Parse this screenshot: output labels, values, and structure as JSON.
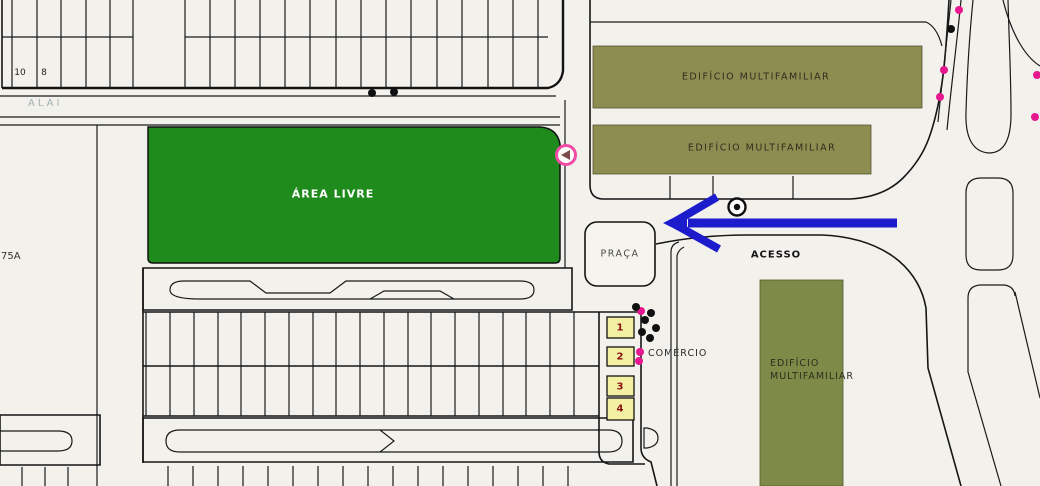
{
  "map": {
    "street_top": "ALAI",
    "street_left": "75A",
    "lot_number_1": "10",
    "lot_number_2": "8",
    "open_area": "ÁREA LIVRE",
    "building_top": "EDIFÍCIO MULTIFAMILIAR",
    "building_middle": "EDIFÍCIO MULTIFAMILIAR",
    "building_right_line1": "EDIFÍCIO",
    "building_right_line2": "MULTIFAMILIAR",
    "plaza": "PRAÇA",
    "access": "ACESSO",
    "commerce": "COMÉRCIO",
    "commerce_units": [
      "1",
      "2",
      "3",
      "4"
    ]
  },
  "colors": {
    "open_area_green": "#1f8b1d",
    "building_olive": "#8d8d52",
    "building_olive_dark": "#7e8b48",
    "commerce_yellow": "#f3f0a3",
    "arrow_blue": "#1c1ccd",
    "marker_magenta": "#e61890",
    "marker_ring_pink": "#f04ca6",
    "dot_black": "#101010"
  },
  "icons": {
    "access_direction": "arrow-left-icon",
    "stop_point": "circle-dot-icon",
    "corner_marker": "pink-circle-marker-icon"
  },
  "markers": {
    "magenta": [
      [
        959,
        10
      ],
      [
        944,
        70
      ],
      [
        940,
        97
      ],
      [
        1037,
        75
      ],
      [
        1035,
        117
      ],
      [
        641,
        311
      ],
      [
        640,
        352
      ],
      [
        639,
        361
      ]
    ],
    "black": [
      [
        951,
        29
      ],
      [
        372,
        93
      ],
      [
        394,
        92
      ],
      [
        636,
        307
      ],
      [
        651,
        313
      ],
      [
        645,
        320
      ],
      [
        656,
        328
      ],
      [
        642,
        332
      ],
      [
        650,
        338
      ]
    ]
  }
}
